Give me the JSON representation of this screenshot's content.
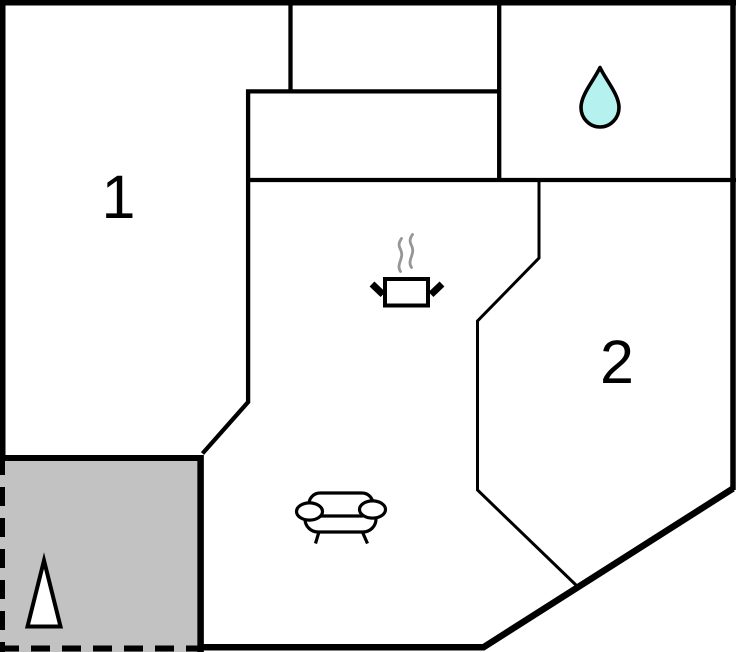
{
  "floorplan": {
    "room_labels": [
      {
        "id": "room-1",
        "text": "1"
      },
      {
        "id": "room-2",
        "text": "2"
      }
    ],
    "icons": [
      {
        "name": "water-drop-icon"
      },
      {
        "name": "cooking-pot-icon"
      },
      {
        "name": "steam-icon"
      },
      {
        "name": "sofa-icon"
      },
      {
        "name": "tree-icon"
      }
    ],
    "colors": {
      "wall": "#000000",
      "terrace_fill": "#c2c2c2",
      "water_drop_fill": "#b5f1ef",
      "steam": "#969696",
      "icon_fill": "#ffffff",
      "background": "#ffffff"
    }
  }
}
